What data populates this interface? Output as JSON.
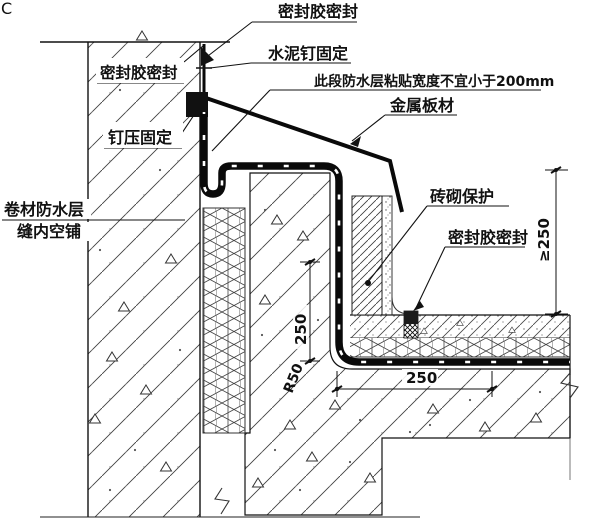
{
  "drawing": {
    "watermark": "C",
    "callouts": {
      "seal_top": {
        "text": "密封胶密封"
      },
      "cement_nail": {
        "text": "水泥钉固定"
      },
      "bond_width_note": {
        "text": "此段防水层粘贴宽度不宜小于200mm"
      },
      "metal_sheet": {
        "text": "金属板材"
      },
      "seal_left": {
        "text": "密封胶密封"
      },
      "nail_fix": {
        "text": "钉压固定"
      },
      "membrane_l1": {
        "text": "卷材防水层"
      },
      "membrane_l2": {
        "text": "缝内空铺"
      },
      "brick_protect": {
        "text": "砖砌保护"
      },
      "seal_right": {
        "text": "密封胶密封"
      }
    },
    "dimensions": {
      "height_min": "≥250",
      "upstand_height": "250",
      "corner_radius": "R50",
      "base_width": "250"
    },
    "colors": {
      "line": "#111111",
      "hatch": "#3f3f3f",
      "membrane": "#0a0a0a",
      "paper": "#ffffff"
    }
  }
}
